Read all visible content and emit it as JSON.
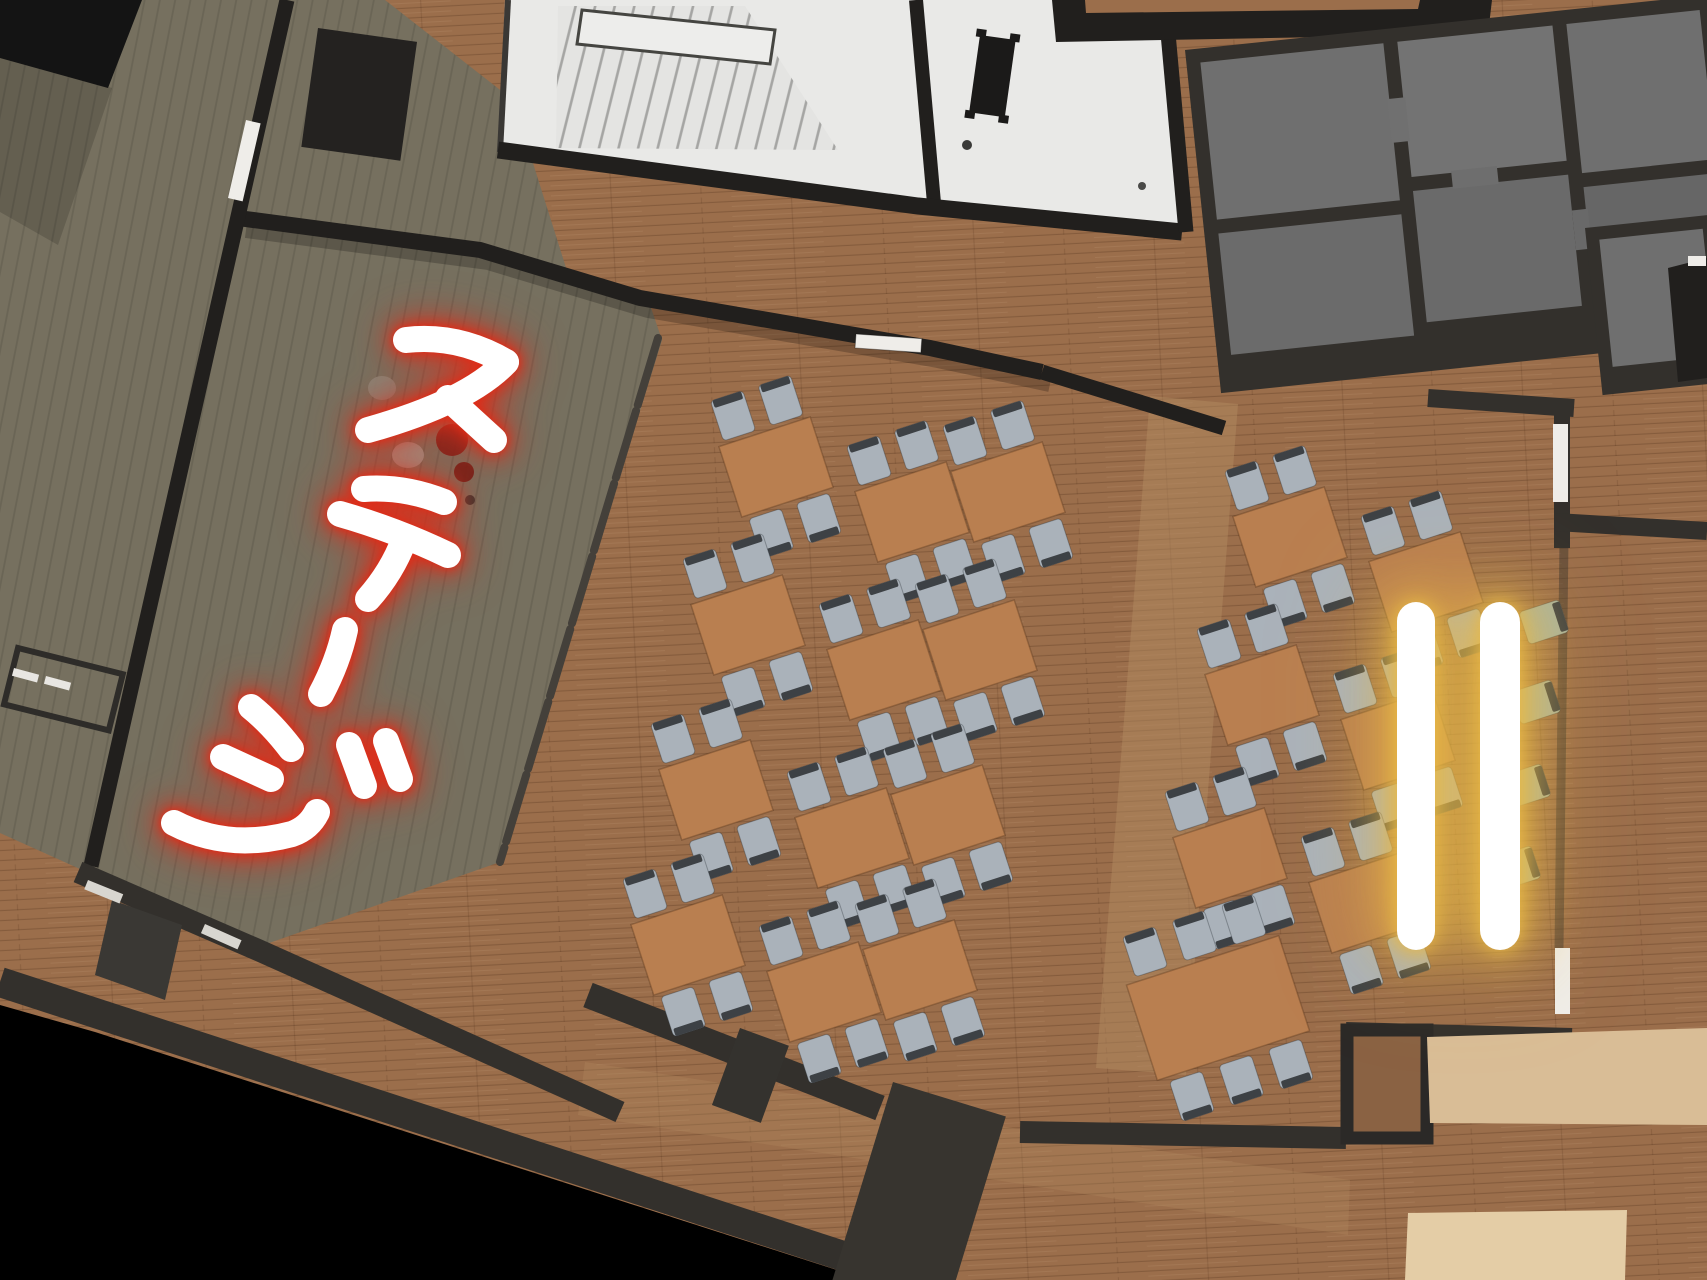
{
  "annotation": {
    "stage_label": "ステージ"
  },
  "highlight": {
    "bar_count": 2
  },
  "colors": {
    "void": "#000000",
    "wood_floor": "#9b6e4b",
    "wood_shade": "#8a6243",
    "walkway": "#b28a5f",
    "stage_floor": "#76705f",
    "wall_dark": "#33302c",
    "wall_black": "#211f1d",
    "white_floor": "#e9e9e7",
    "stair_line": "#a5a5a3",
    "landing": "#ededeb",
    "room_gray": "#6f6f6f",
    "room_gray_dark": "#666666",
    "table_wood": "#b97f50",
    "chair_gray": "#aab2ba",
    "chair_green": "#a9b39f",
    "chair_back": "#3d4145",
    "beige_floor": "#d9bd96",
    "beige_light": "#e4cda6",
    "door_white": "#efede9",
    "annotation_ink": "#ffffff",
    "annotation_glow": "#e02c18",
    "highlight_bar": "#ffffff",
    "highlight_glow": "#e9b945"
  }
}
